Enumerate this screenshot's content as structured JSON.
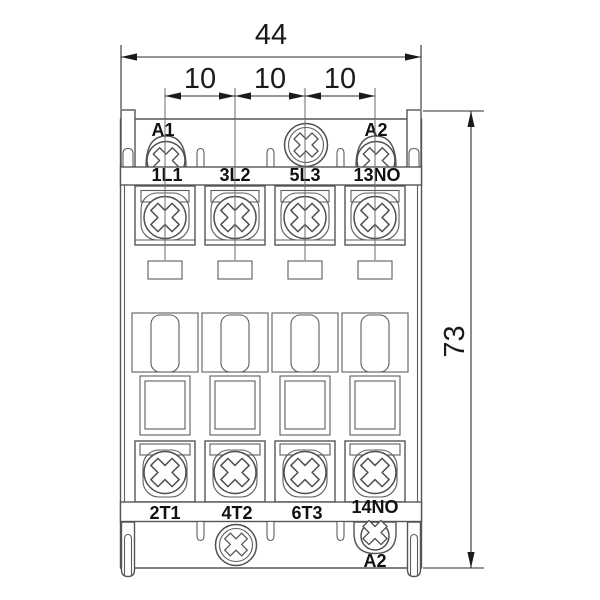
{
  "dimensions": {
    "overall_width": "44",
    "terminal_pitch": [
      "10",
      "10",
      "10"
    ],
    "overall_height": "73"
  },
  "coil_terminals": {
    "top_left": "A1",
    "top_right": "A2",
    "bottom": "A2"
  },
  "line_terminals": [
    "1L1",
    "3L2",
    "5L3",
    "13NO"
  ],
  "load_terminals": [
    "2T1",
    "4T2",
    "6T3",
    "14NO"
  ],
  "colors": {
    "line": "#555555",
    "dimension": "#1a1a1a",
    "background": "#ffffff"
  }
}
